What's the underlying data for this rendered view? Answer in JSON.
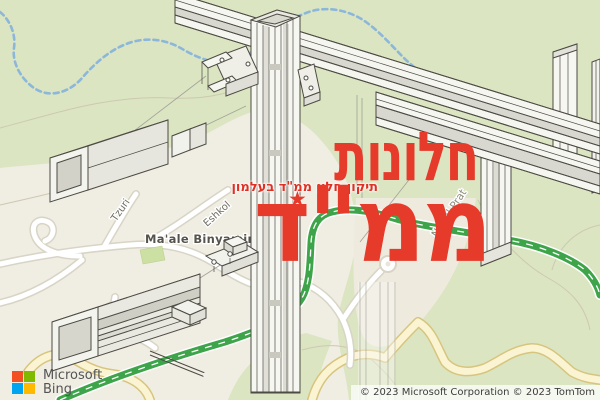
{
  "overlay": {
    "title_line1": "חלונות",
    "title_line2": "ממ\"ד",
    "subtitle": "תיקון חלון ממ\"ד בעלמון",
    "star": "★",
    "accent_color": "#e63a2b"
  },
  "map": {
    "labels": {
      "settlement": "Ma'ale Binyamin",
      "street_1": "Tzuri",
      "street_2": "Eshkol",
      "street_3": "Noit",
      "stream": "Nahal Prat"
    },
    "colors": {
      "land": "#dbe5c1",
      "urban": "#f0ede3",
      "road_fill": "#ffffff",
      "road_casing": "#d8d4c6",
      "highway_green": "#3ea44a",
      "yellow_road_fill": "#fbf4d3",
      "yellow_road_casing": "#d7c57e",
      "trail_blue": "#8cb7da"
    }
  },
  "attribution": {
    "brand_line1": "Microsoft",
    "brand_line2": "Bing",
    "copyright": "© 2023 Microsoft Corporation © 2023 TomTom",
    "logo": {
      "tl": "#f25022",
      "tr": "#7fba00",
      "bl": "#00a4ef",
      "br": "#ffb900"
    }
  }
}
